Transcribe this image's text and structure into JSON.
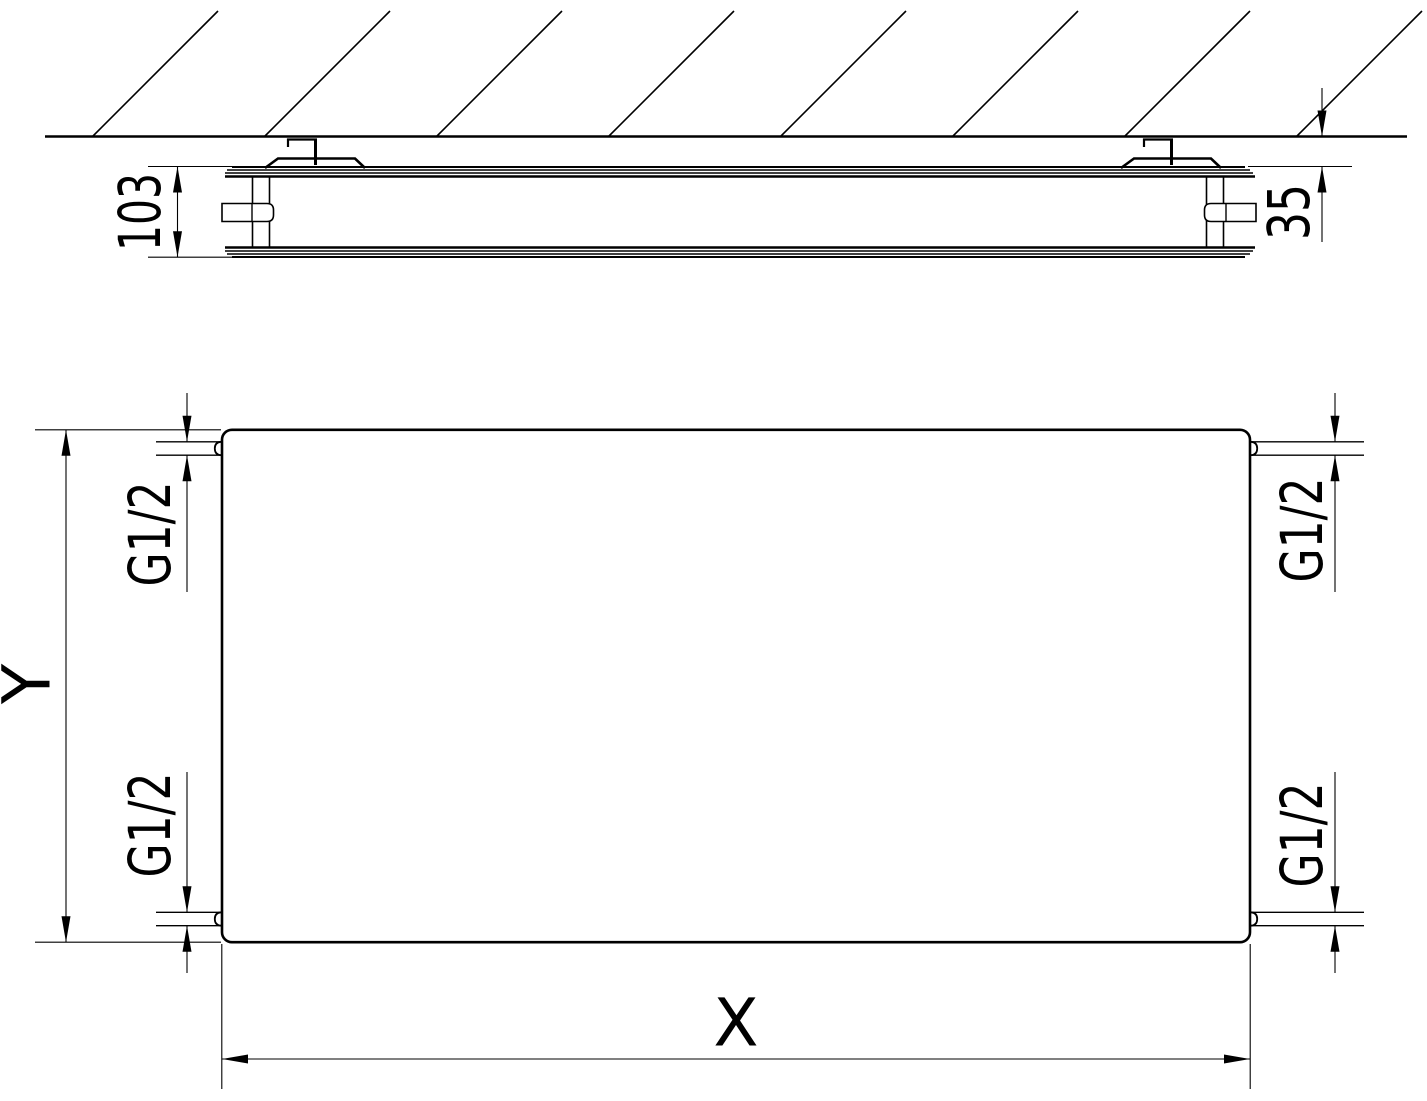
{
  "drawing": {
    "type": "technical-dimension-drawing",
    "side_view": {
      "depth_label": "103",
      "wall_distance_label": "35"
    },
    "front_view": {
      "height_label": "Y",
      "width_label": "X",
      "connections": {
        "top_left": "G1/2",
        "bottom_left": "G1/2",
        "top_right": "G1/2",
        "bottom_right": "G1/2"
      }
    },
    "colors": {
      "line": "#000000",
      "background": "#ffffff",
      "text": "#000000"
    }
  }
}
